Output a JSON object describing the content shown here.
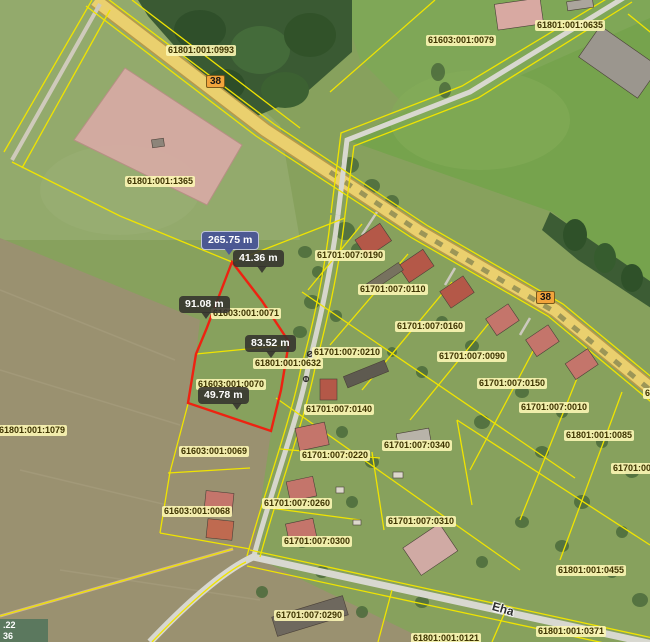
{
  "map": {
    "title": "cadastral-aerial-map",
    "colors": {
      "selection_red": "#ee2211",
      "boundary_yellow": "#f0e400",
      "measure_primary_bg": "#485496",
      "measure_dark_bg": "#34322e",
      "parcel_label_bg": "#fcf6b4",
      "road_badge_bg": "#f2a43c",
      "road_fill": "#ead06e",
      "field_fill": "#9a9170",
      "pink_parcel_fill": "#d6aba3"
    },
    "road_badges": [
      {
        "text": "38",
        "x": 206,
        "y": 75
      },
      {
        "text": "38",
        "x": 536,
        "y": 291
      }
    ],
    "street_name": {
      "text": "Eha",
      "x": 492,
      "y": 602
    },
    "coordinate_overlay": {
      "line1": ".22",
      "line2": "36"
    },
    "parcel_labels": [
      {
        "text": "61801:001:0993",
        "x": 166,
        "y": 45
      },
      {
        "text": "61603:001:0079",
        "x": 426,
        "y": 35
      },
      {
        "text": "61801:001:0635",
        "x": 535,
        "y": 20
      },
      {
        "text": "61801:001:1365",
        "x": 125,
        "y": 176
      },
      {
        "text": "61701:007:0190",
        "x": 315,
        "y": 250
      },
      {
        "text": "61701:007:0110",
        "x": 358,
        "y": 284
      },
      {
        "text": "61701:007:0160",
        "x": 395,
        "y": 321
      },
      {
        "text": "61701:007:0210",
        "x": 312,
        "y": 347
      },
      {
        "text": "61801:001:0632",
        "x": 253,
        "y": 358
      },
      {
        "text": "61701:007:0090",
        "x": 437,
        "y": 351
      },
      {
        "text": "61701:007:0150",
        "x": 477,
        "y": 378
      },
      {
        "text": "61701:007:0140",
        "x": 304,
        "y": 404
      },
      {
        "text": "61701:007:0010",
        "x": 519,
        "y": 402
      },
      {
        "text": "61801:001:0085",
        "x": 564,
        "y": 430
      },
      {
        "text": "61603:001:0071",
        "x": 211,
        "y": 308
      },
      {
        "text": "61603:001:0070",
        "x": 196,
        "y": 379
      },
      {
        "text": "61801:001:1079",
        "x": -3,
        "y": 425
      },
      {
        "text": "61603:001:0069",
        "x": 179,
        "y": 446
      },
      {
        "text": "61603:001:0068",
        "x": 162,
        "y": 506
      },
      {
        "text": "61701:007:0220",
        "x": 300,
        "y": 450
      },
      {
        "text": "61701:007:0340",
        "x": 382,
        "y": 440
      },
      {
        "text": "61701:007:0260",
        "x": 262,
        "y": 498
      },
      {
        "text": "61701:007:0310",
        "x": 386,
        "y": 516
      },
      {
        "text": "61701:007:0300",
        "x": 282,
        "y": 536
      },
      {
        "text": "61801:001:0455",
        "x": 556,
        "y": 565
      },
      {
        "text": "61701:007:0290",
        "x": 274,
        "y": 610
      },
      {
        "text": "61801:001:0371",
        "x": 536,
        "y": 626
      },
      {
        "text": "61801:001:0121",
        "x": 411,
        "y": 633
      },
      {
        "text": "61701:00",
        "x": 611,
        "y": 463
      },
      {
        "text": "6",
        "x": 643,
        "y": 388
      }
    ],
    "measurements": [
      {
        "text": "265.75 m",
        "x": 201,
        "y": 231,
        "style": "primary",
        "tail_x": 22
      },
      {
        "text": "41.36 m",
        "x": 233,
        "y": 250,
        "style": "dark",
        "tail_x": 24
      },
      {
        "text": "91.08 m",
        "x": 179,
        "y": 296,
        "style": "dark",
        "tail_x": 22
      },
      {
        "text": "83.52 m",
        "x": 245,
        "y": 335,
        "style": "dark",
        "tail_x": 21
      },
      {
        "text": "49.78 m",
        "x": 198,
        "y": 387,
        "style": "dark",
        "tail_x": 34
      }
    ]
  }
}
